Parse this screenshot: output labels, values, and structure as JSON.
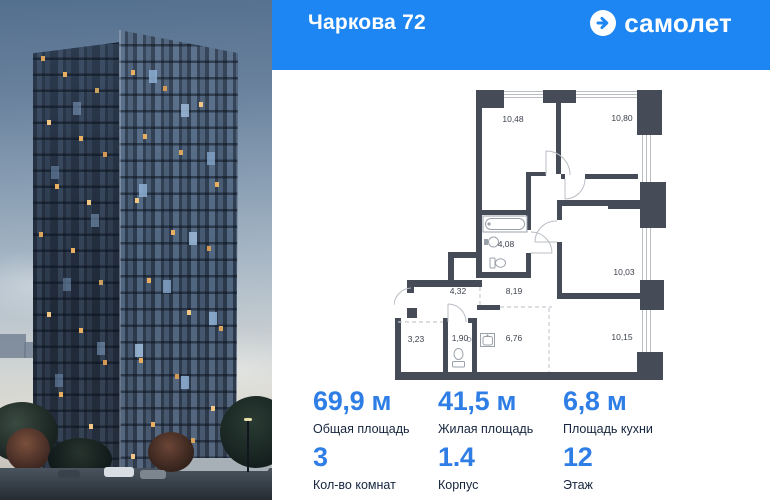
{
  "header": {
    "title": "Чаркова 72",
    "brand": "самолет"
  },
  "floor_plan": {
    "rooms": [
      {
        "id": "bedroom-1",
        "area": "10,48"
      },
      {
        "id": "bedroom-2",
        "area": "10,80"
      },
      {
        "id": "bathroom",
        "area": "4,08"
      },
      {
        "id": "room-3",
        "area": "10,03"
      },
      {
        "id": "hallway",
        "area": "4,32"
      },
      {
        "id": "corridor",
        "area": "8,19"
      },
      {
        "id": "wardrobe",
        "area": "3,23"
      },
      {
        "id": "wc",
        "area": "1,90"
      },
      {
        "id": "kitchen",
        "area": "6,76"
      },
      {
        "id": "living-zone",
        "area": "10,15"
      }
    ]
  },
  "stats": {
    "total_area": {
      "value": "69,9 м",
      "label": "Общая площадь"
    },
    "living_area": {
      "value": "41,5 м",
      "label": "Жилая площадь"
    },
    "kitchen_area": {
      "value": "6,8 м",
      "label": "Площадь кухни"
    },
    "room_count": {
      "value": "3",
      "label": "Кол-во комнат"
    },
    "building": {
      "value": "1.4",
      "label": "Корпус"
    },
    "floor": {
      "value": "12",
      "label": "Этаж"
    }
  },
  "colors": {
    "brand_blue": "#1e86f2",
    "stat_value_blue": "#2e7ee6",
    "label_navy": "#15243d",
    "plan_wall": "#454b57"
  }
}
